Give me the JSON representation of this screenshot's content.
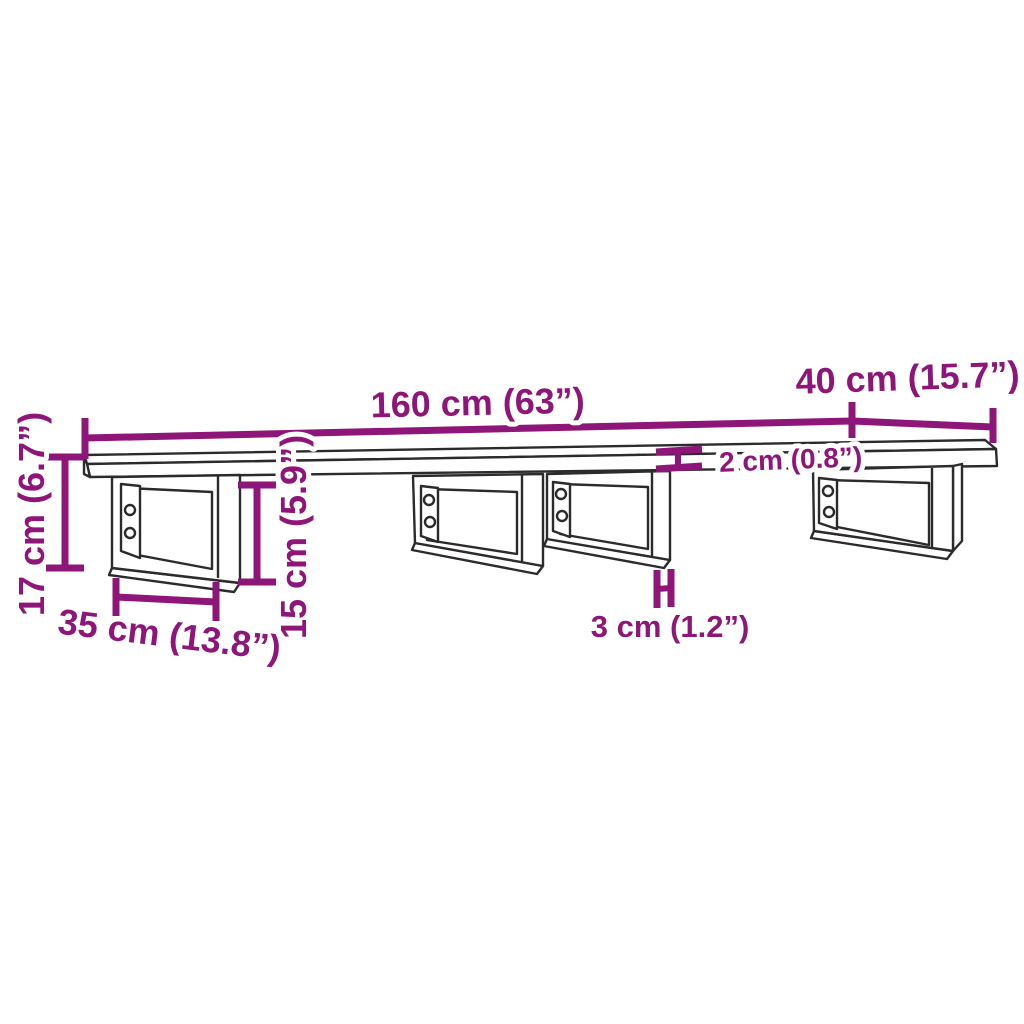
{
  "meta": {
    "title": "Wall shelf with steel brackets — dimension diagram",
    "background_color": "#ffffff",
    "outline_color": "#2d2a2b",
    "accent_color": "#8E1679",
    "halo_color": "#ffffff"
  },
  "labels": {
    "length": "160 cm (63”)",
    "depth": "40 cm (15.7”)",
    "board_thickness": "2 cm (0.8”)",
    "overall_height": "17 cm (6.7”)",
    "bracket_depth": "35 cm (13.8”)",
    "bracket_height": "15 cm (5.9”)",
    "bracket_bar_width": "3 cm (1.2”)"
  }
}
